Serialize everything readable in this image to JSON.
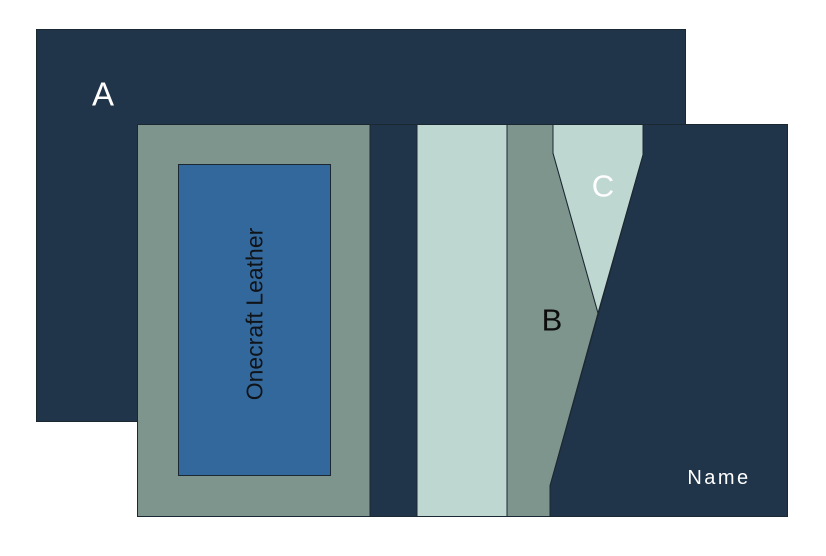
{
  "diagram": {
    "back_panel": {
      "label": "A"
    },
    "front_panel": {
      "patch": {
        "label": "Onecraft Leather"
      },
      "strip_b": {
        "label": "B"
      },
      "wedge_c": {
        "label": "C"
      },
      "name_area": {
        "label": "Name"
      }
    },
    "colors": {
      "navy": "#20344A",
      "sage": "#7E958E",
      "pale": "#BFD7D1",
      "blue": "#33689D",
      "outline": "#1B2831"
    }
  }
}
